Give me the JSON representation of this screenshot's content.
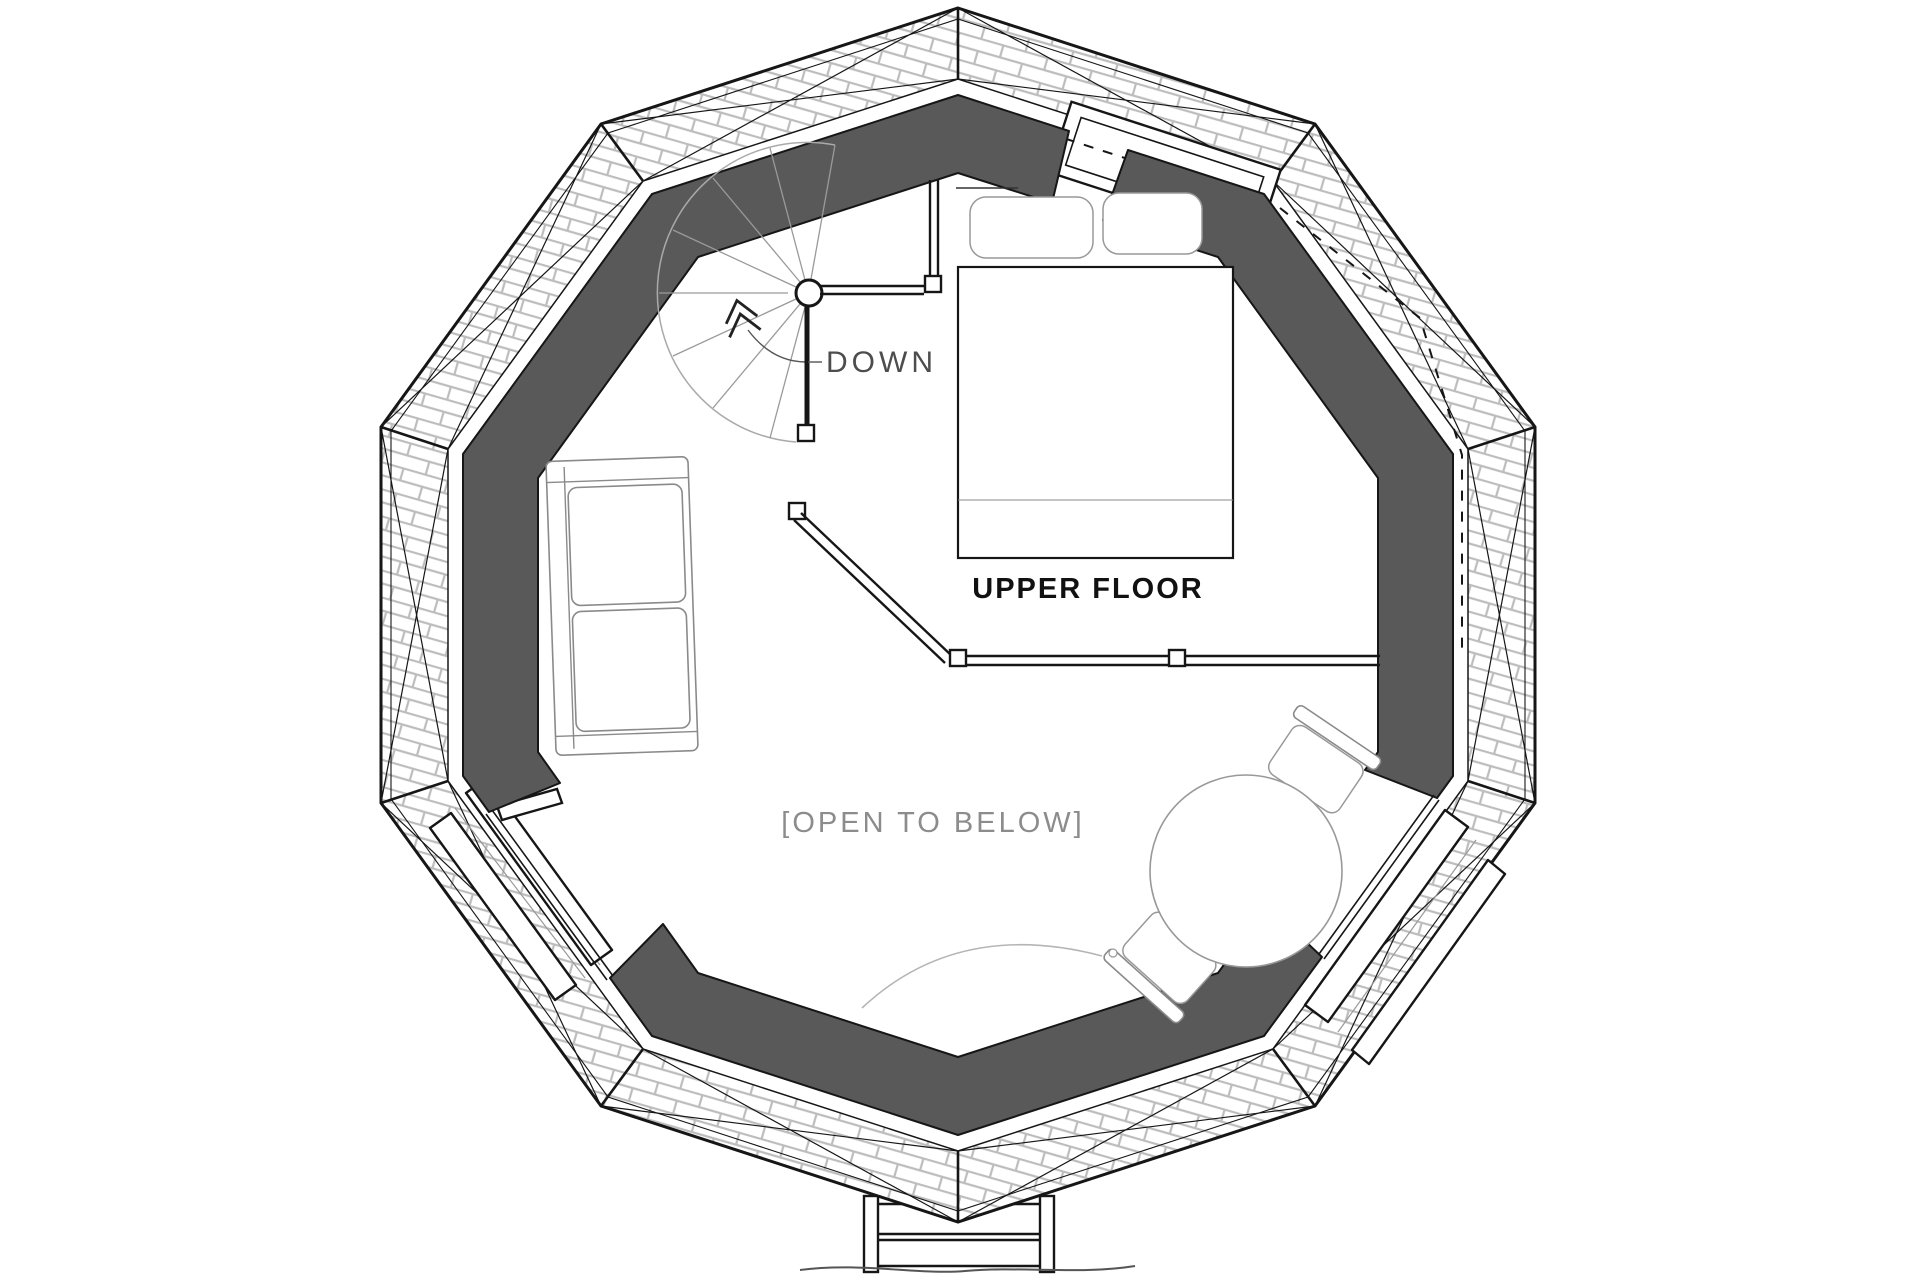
{
  "title": "Upper floor plan of decagonal dome cabin",
  "labels": {
    "down": "DOWN",
    "upper_floor": "UPPER FLOOR",
    "open_to_below": "[OPEN TO BELOW]"
  },
  "rooms": {
    "loft": "UPPER FLOOR",
    "void": "[OPEN TO BELOW]"
  },
  "stairs": {
    "direction_label": "DOWN",
    "type": "spiral"
  },
  "icons": [
    "chevron-up-icon"
  ],
  "colors": {
    "wall_band": "#595959",
    "line_ink": "#161616",
    "shingle_line": "#bdbdbd",
    "furniture_gray": "#999999",
    "label_gray": "#8c8c8c",
    "background": "#ffffff"
  }
}
